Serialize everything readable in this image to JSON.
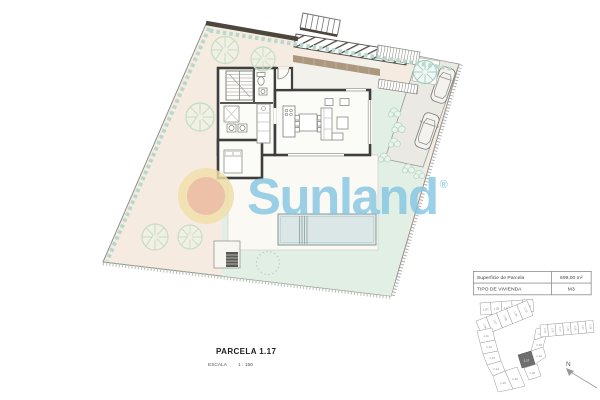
{
  "document": {
    "parcel_title": "PARCELA 1.17",
    "scale_label": "ESCALA",
    "scale_value": "1 : 150"
  },
  "info_table": {
    "rows": [
      {
        "label": "Superficie de Parcela",
        "value": "699,00 m²"
      },
      {
        "label": "TIPO DE VIVIENDA",
        "value": "M3"
      }
    ]
  },
  "watermark": {
    "brand": "Sunland",
    "registered": "®",
    "text_color": "#85c6e3",
    "sun_ring_color": "#f1dfa9",
    "sun_core_color": "#eab99c"
  },
  "compass": {
    "label": "N"
  },
  "site_plan": {
    "highlighted_lot": "1.17",
    "lots": [
      "1.01",
      "1.02",
      "1.03",
      "1.04",
      "1.05",
      "1.06",
      "1.07",
      "1.08",
      "1.09",
      "1.10",
      "1.11",
      "1.12",
      "1.13",
      "1.14",
      "1.15",
      "1.16",
      "1.17",
      "1.18",
      "1.19",
      "1.20",
      "1.21",
      "1.22",
      "1.23",
      "1.24",
      "1.25",
      "1.26",
      "1.27",
      "1.28"
    ]
  },
  "palette": {
    "garden_peach": "#f6ebe1",
    "lawn_green": "#e1efe5",
    "pool_blue": "#dbe7e7",
    "wall_dark": "#3e3e3c",
    "hatch_teal": "#b7d9cc"
  }
}
